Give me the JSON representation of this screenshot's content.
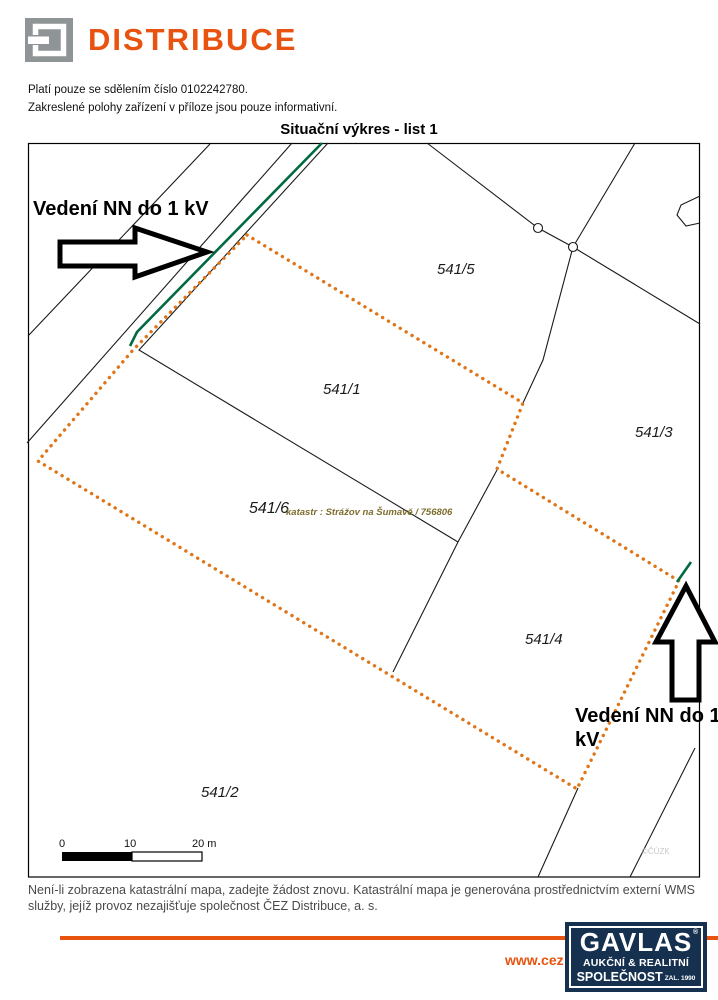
{
  "page": {
    "header": {
      "brand": "DISTRIBUCE",
      "note1": "Platí pouze se sdělením číslo 0102242780.",
      "note2": "Zakreslené polohy zařízení v příloze jsou pouze informativní."
    },
    "map": {
      "title": "Situační výkres - list 1",
      "arrow1_label": "Vedení NN do 1 kV",
      "arrow2_label_line1": "Vedení NN do 1",
      "arrow2_label_line2": "kV",
      "parcels": {
        "p541_5": "541/5",
        "p541_1": "541/1",
        "p541_3": "541/3",
        "p541_6": "541/6",
        "p541_4": "541/4",
        "p541_2": "541/2"
      },
      "cadastre_note": "katastr : Strážov na Šumavě / 756806",
      "watermark": "©ČÚZK",
      "scale": {
        "tick0": "0",
        "tick10": "10",
        "tick20": "20 m"
      }
    },
    "footer": {
      "wms_line1": "Není-li zobrazena katastrální mapa, zadejte žádost znovu. Katastrální mapa je generována prostřednictvím externí WMS",
      "wms_line2": "služby, jejíž provoz nezajišťuje společnost ČEZ Distribuce, a. s.",
      "url_text": "www.cez",
      "gavlas": {
        "name": "GAVLAS",
        "reg": "®",
        "tagline1": "AUKČNÍ & REALITNÍ",
        "tagline2": "SPOLEČNOST",
        "since": "ZAL. 1990"
      }
    },
    "colors": {
      "accent_orange": "#E8530F",
      "boundary_orange": "#E07518",
      "nn_green": "#006B40",
      "gavlas_navy": "#16304F",
      "logo_gray": "#8F9496"
    }
  }
}
